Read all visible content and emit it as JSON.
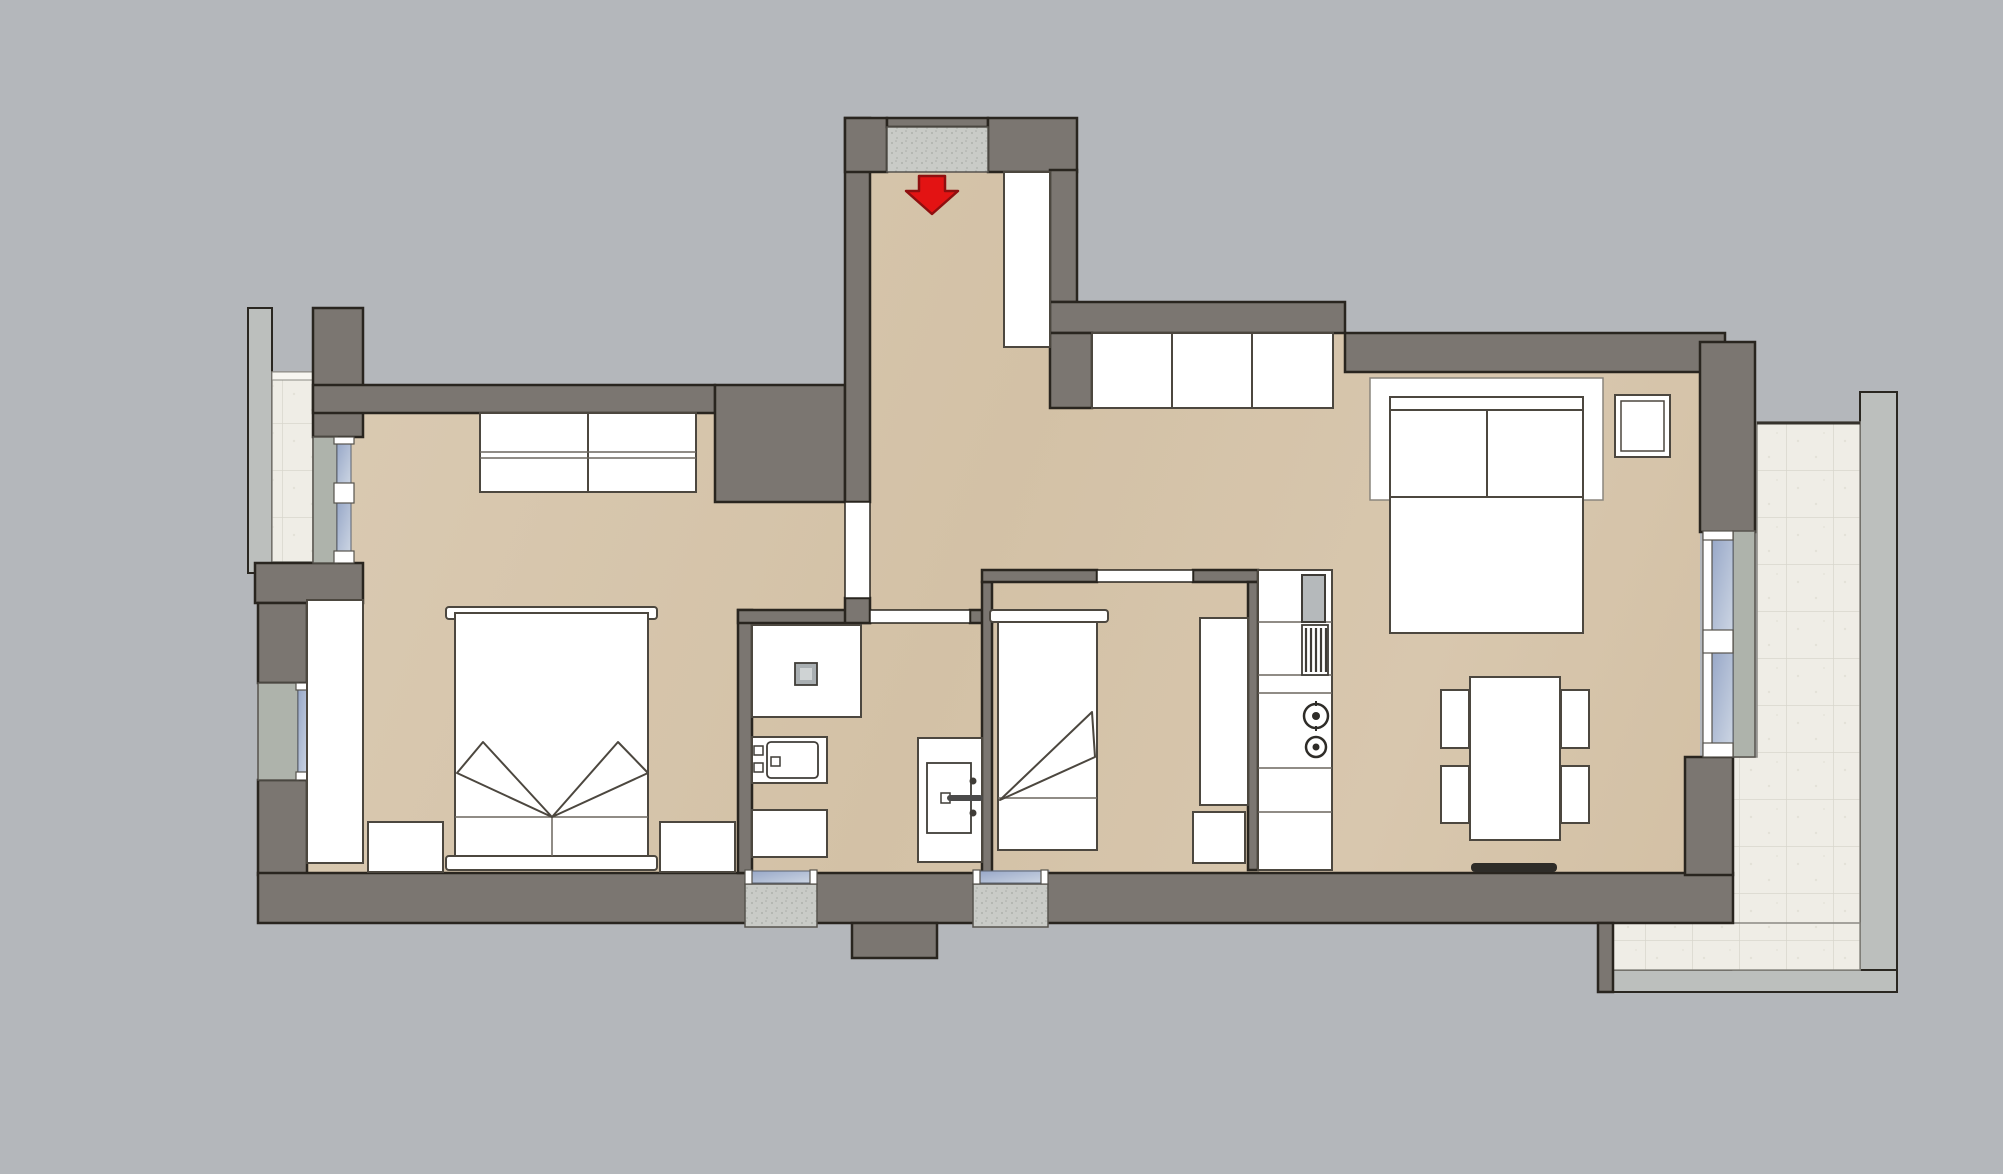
{
  "colors": {
    "bg": "#b4b7bb",
    "wall": "#7b7671",
    "wall_outline": "#29251f",
    "floor": "#d6c5ac",
    "floor_light": "#dccdb6",
    "floor_dark": "#d0bda1",
    "furniture": "#ffffff",
    "furniture_outline": "#4c473f",
    "tile": "#efede6",
    "tile_line": "#d8d6cd",
    "rail": "#bcbfbd",
    "concrete": "#aeb3ab",
    "speckle": "#c9cbc7",
    "glass_light": "#ccd5e3",
    "glass_dark": "#98a8c8",
    "arrow": "#e31313",
    "arrow_outline": "#8f0f0f",
    "appliance_gray": "#b5b9bb",
    "radiator": "#2e2c28"
  },
  "icons": {
    "entrance_arrow": "red-down-arrow"
  },
  "labels": {
    "plan": "apartment floor plan",
    "entrance": "entrance",
    "entrance_hall": "entrance hall",
    "bedroom_main": "main bedroom",
    "bathroom": "bathroom",
    "bedroom_second": "second bedroom",
    "kitchen": "kitchen",
    "living_dining": "living and dining area",
    "balcony_left": "left balcony",
    "balcony_right": "terrace balcony"
  }
}
